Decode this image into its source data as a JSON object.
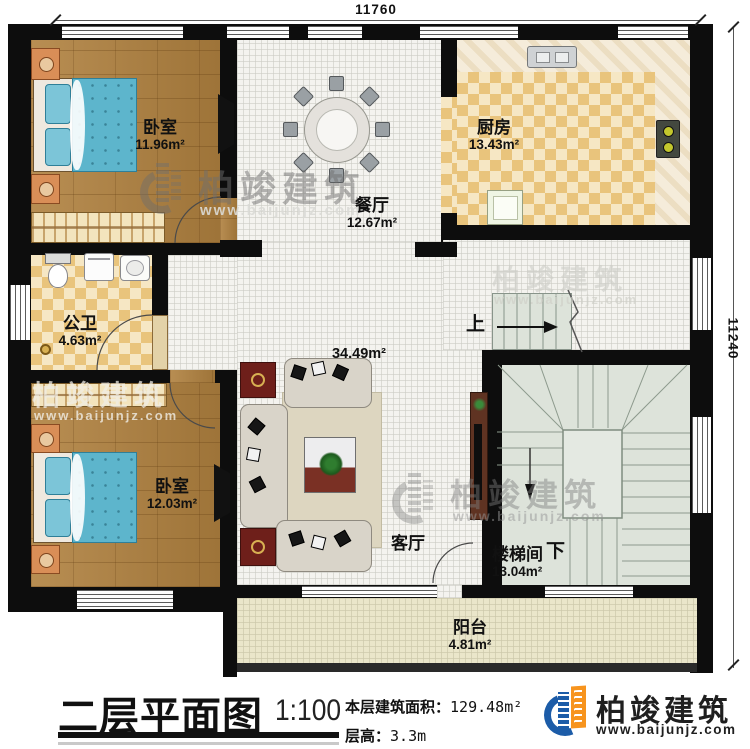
{
  "plan": {
    "dimensions": {
      "top": "11760",
      "right": "11240"
    },
    "rooms": {
      "bedroom1": {
        "name": "卧室",
        "area": "11.96m²"
      },
      "dining": {
        "name": "餐厅",
        "area": "12.67m²"
      },
      "kitchen": {
        "name": "厨房",
        "area": "13.43m²"
      },
      "bathroom": {
        "name": "公卫",
        "area": "4.63m²"
      },
      "bedroom2": {
        "name": "卧室",
        "area": "12.03m²"
      },
      "living": {
        "name": "客厅",
        "area": "34.49m²"
      },
      "stairwell": {
        "name": "楼梯间",
        "area": "13.04m²"
      },
      "balcony": {
        "name": "阳台",
        "area": "4.81m²"
      }
    },
    "stair_direction_up": "上",
    "stair_direction_down": "下"
  },
  "title_block": {
    "title": "二层平面图",
    "scale": "1:100",
    "floor_area_label": "本层建筑面积：",
    "floor_area_value": "129.48m²",
    "floor_height_label": "层高：",
    "floor_height_value": "3.3m"
  },
  "brand": {
    "name": "柏竣建筑",
    "website": "www.baijunjz.com"
  },
  "watermark": {
    "name": "柏竣建筑",
    "website": "www.baijunjz.com"
  },
  "colors": {
    "wall": "#0d0d0d",
    "wood_floor": "#b0813f",
    "tile_floor": "#f4f3ef",
    "checker_floor": "#e9c47c",
    "balcony_floor": "#eae6ca",
    "stair_floor": "#dde3da",
    "brand_blue": "#1c5ca8",
    "brand_orange": "#f7941e"
  }
}
